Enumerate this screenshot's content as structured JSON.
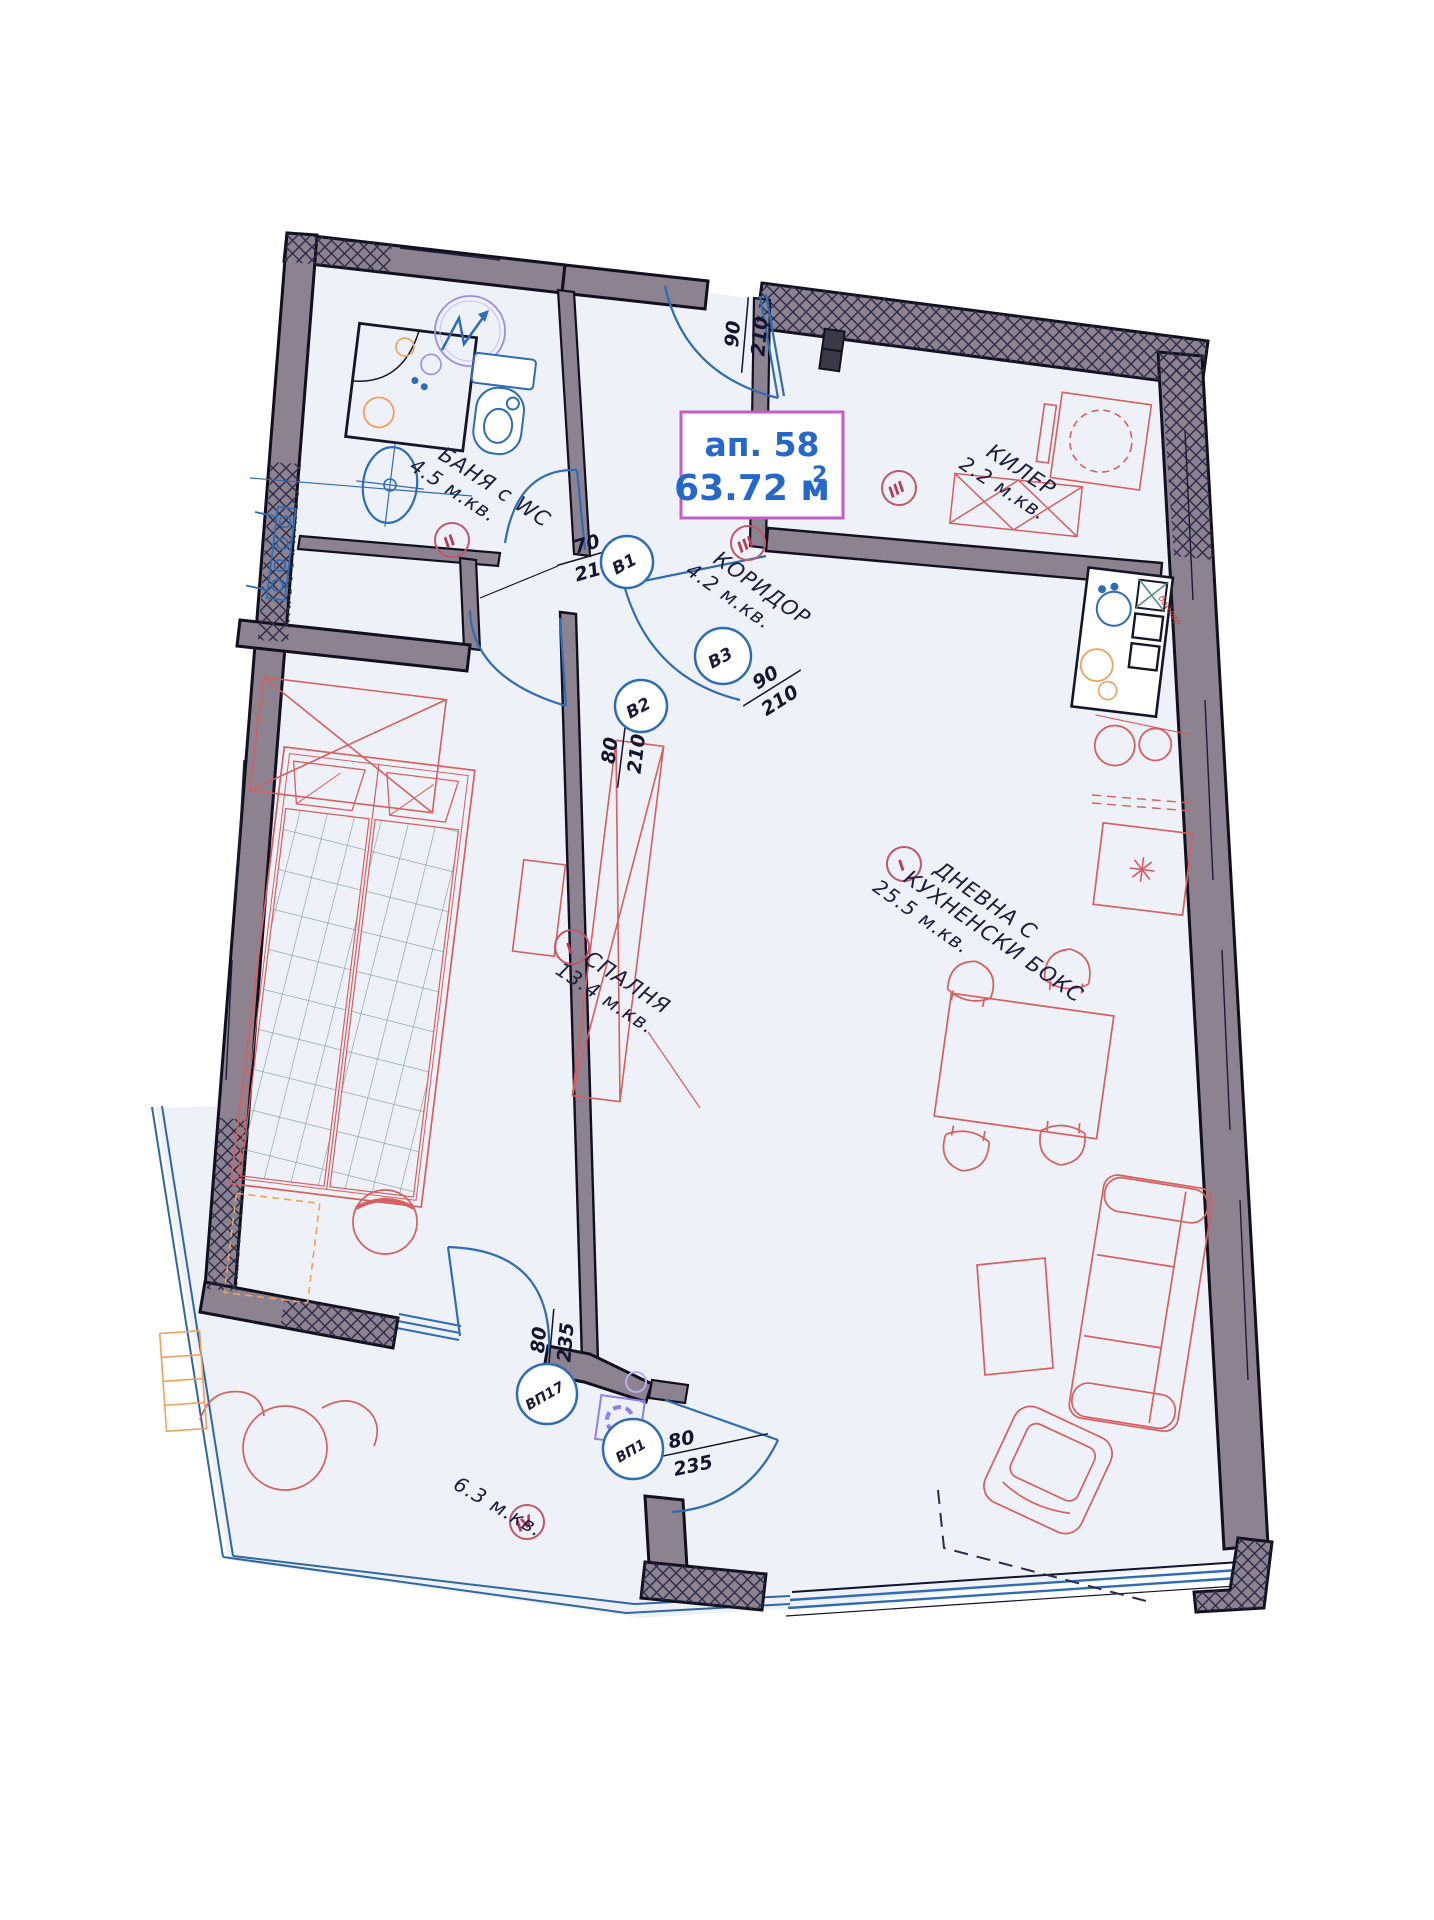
{
  "title_box": {
    "apartment_label": "ап. 58",
    "area_value": "63.72 м",
    "area_superscript": "2"
  },
  "rooms": {
    "bathroom": {
      "name": "БАНЯ с WC",
      "area": "4.5 м.кв.",
      "floor_mark": "II"
    },
    "corridor": {
      "name": "КОРИДОР",
      "area": "4.2 м.кв.",
      "floor_mark": "III"
    },
    "storage": {
      "name": "КИЛЕР",
      "area": "2.2 м.кв.",
      "floor_mark": "III"
    },
    "bedroom": {
      "name": "СПАЛНЯ",
      "area": "13.4 м.кв.",
      "floor_mark": "I"
    },
    "living": {
      "name_line1": "ДНЕВНА С",
      "name_line2": "КУХНЕНСКИ БОКС",
      "area": "25.5 м.кв.",
      "floor_mark": "I"
    },
    "balcony": {
      "area": "6.3 м.кв.",
      "floor_mark": "IV"
    }
  },
  "doors": {
    "entrance": {
      "width": "90",
      "height": "210"
    },
    "b1": {
      "id": "В1",
      "width": "70",
      "height": "210"
    },
    "b2": {
      "id": "В2",
      "width": "80",
      "height": "210"
    },
    "b3": {
      "id": "В3",
      "width": "90",
      "height": "210"
    },
    "vp17": {
      "id": "ВП17",
      "width": "80",
      "height": "235"
    },
    "vp1": {
      "id": "ВП1",
      "width": "80",
      "height": "235"
    }
  },
  "kitchen": {
    "boiler_label": "бойлер"
  },
  "palette": {
    "wall_gray": "#8d8390",
    "hatch_navy": "#2b2b4a",
    "interior_fill": "#eef1f8",
    "fixture_blue": "#2e6cb5",
    "furniture_red": "#d65f5f",
    "accent_orange": "#eda25e",
    "symbol_purple": "#8f7ff0",
    "mark_red": "#c2566a",
    "title_border_magenta": "#c45ec4",
    "title_text_blue": "#2668c8"
  }
}
